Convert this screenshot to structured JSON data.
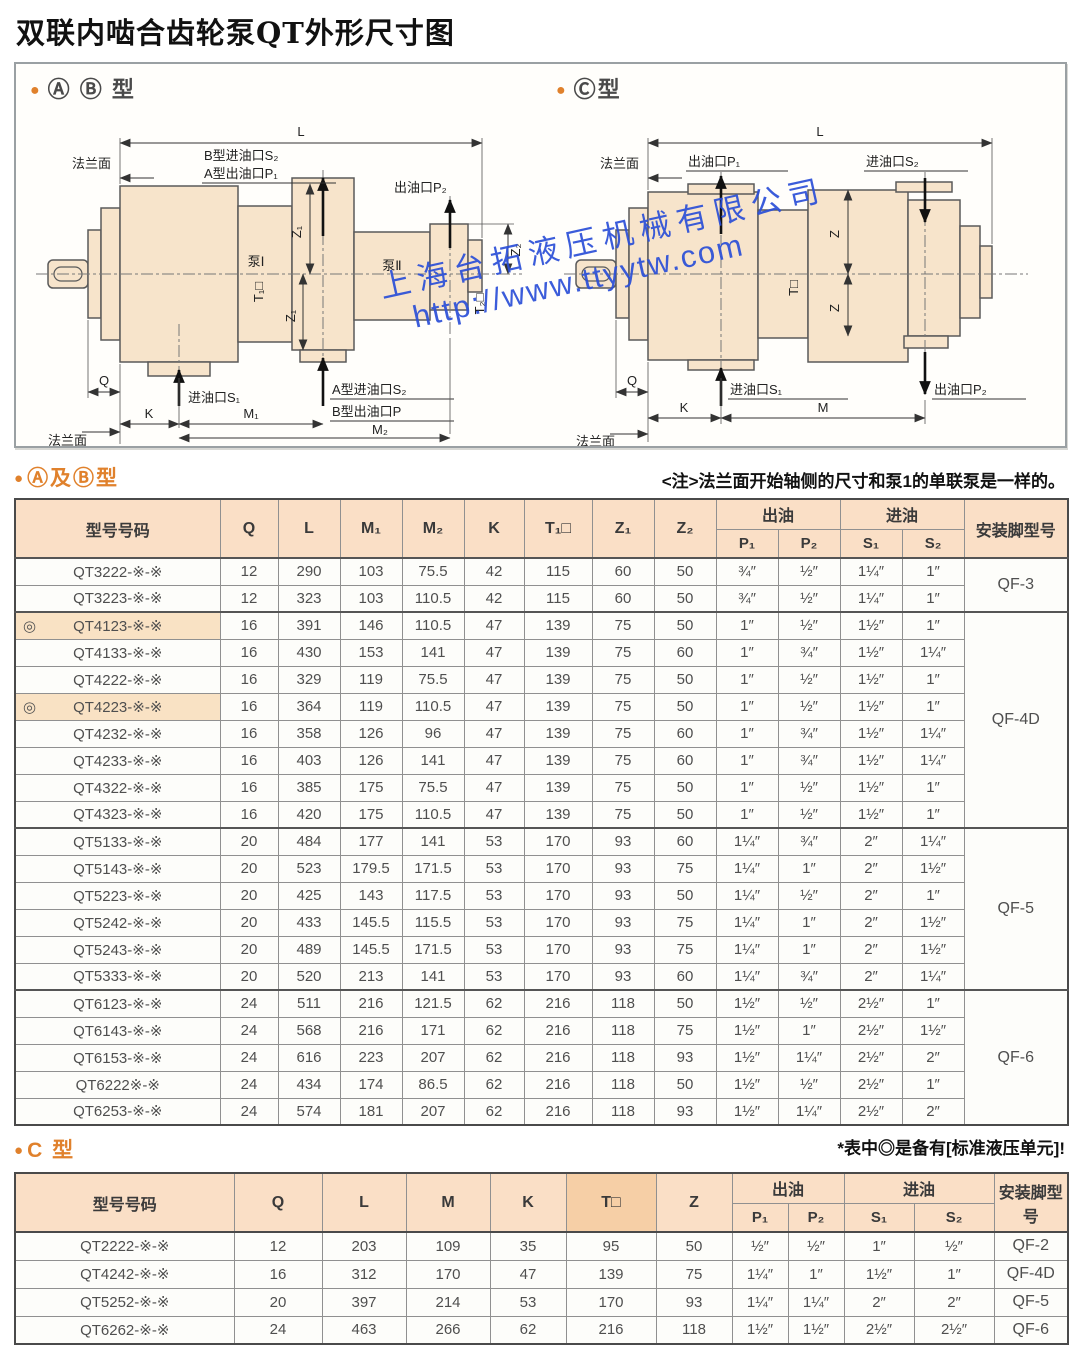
{
  "page_title": "双联内啮合齿轮泵QT外形尺寸图",
  "watermark": {
    "company": "上海台拓液压机械有限公司",
    "url": "http://www.ttyytw.com"
  },
  "diagram_ab": {
    "bullet": "●",
    "title": "Ⓐ Ⓑ 型",
    "labels": {
      "L": "L",
      "flange_top": "法兰面",
      "b_inlet_s2": "B型进油口S₂",
      "a_outlet_p1": "A型出油口P₁",
      "outlet_p2": "出油口P₂",
      "z1": "Z₁",
      "z2": "Z₂",
      "t1": "T₁□",
      "t2": "T₂□",
      "pump1": "泵Ⅰ",
      "pump2": "泵Ⅱ",
      "q": "Q",
      "k": "K",
      "m1": "M₁",
      "m2": "M₂",
      "inlet_s1": "进油口S₁",
      "a_inlet_s2": "A型进油口S₂",
      "b_outlet_p": "B型出油口P",
      "flange_bottom": "法兰面"
    }
  },
  "diagram_c": {
    "bullet": "●",
    "title": "Ⓒ型",
    "labels": {
      "L": "L",
      "flange_top": "法兰面",
      "outlet_p1": "出油口P₁",
      "inlet_s2": "进油口S₂",
      "z": "Z",
      "t": "T□",
      "q": "Q",
      "k": "K",
      "m": "M",
      "inlet_s1": "进油口S₁",
      "outlet_p2": "出油口P₂",
      "flange_bottom": "法兰面"
    }
  },
  "section_ab": {
    "bullet": "●",
    "title": "Ⓐ及Ⓑ型",
    "note": "<注>法兰面开始轴侧的尺寸和泵1的单联泵是一样的。"
  },
  "table_ab": {
    "headers": {
      "model": "型号号码",
      "q": "Q",
      "l": "L",
      "m1": "M₁",
      "m2": "M₂",
      "k": "K",
      "t1": "T₁□",
      "z1": "Z₁",
      "z2": "Z₂",
      "out": "出油",
      "in": "进油",
      "p1": "P₁",
      "p2": "P₂",
      "s1": "S₁",
      "s2": "S₂",
      "foot": "安装脚型号"
    },
    "groups": [
      {
        "start": 0,
        "span": 2,
        "label": "QF-3"
      },
      {
        "start": 2,
        "span": 8,
        "label": "QF-4D"
      },
      {
        "start": 10,
        "span": 6,
        "label": "QF-5"
      },
      {
        "start": 16,
        "span": 5,
        "label": "QF-6"
      }
    ],
    "rows": [
      {
        "mark": "",
        "model": "QT3222-※-※",
        "q": "12",
        "l": "290",
        "m1": "103",
        "m2": "75.5",
        "k": "42",
        "t1": "115",
        "z1": "60",
        "z2": "50",
        "p1": "¾″",
        "p2": "½″",
        "s1": "1¼″",
        "s2": "1″"
      },
      {
        "mark": "",
        "model": "QT3223-※-※",
        "q": "12",
        "l": "323",
        "m1": "103",
        "m2": "110.5",
        "k": "42",
        "t1": "115",
        "z1": "60",
        "z2": "50",
        "p1": "¾″",
        "p2": "½″",
        "s1": "1¼″",
        "s2": "1″"
      },
      {
        "mark": "◎",
        "model": "QT4123-※-※",
        "q": "16",
        "l": "391",
        "m1": "146",
        "m2": "110.5",
        "k": "47",
        "t1": "139",
        "z1": "75",
        "z2": "50",
        "p1": "1″",
        "p2": "½″",
        "s1": "1½″",
        "s2": "1″"
      },
      {
        "mark": "",
        "model": "QT4133-※-※",
        "q": "16",
        "l": "430",
        "m1": "153",
        "m2": "141",
        "k": "47",
        "t1": "139",
        "z1": "75",
        "z2": "60",
        "p1": "1″",
        "p2": "¾″",
        "s1": "1½″",
        "s2": "1¼″"
      },
      {
        "mark": "",
        "model": "QT4222-※-※",
        "q": "16",
        "l": "329",
        "m1": "119",
        "m2": "75.5",
        "k": "47",
        "t1": "139",
        "z1": "75",
        "z2": "50",
        "p1": "1″",
        "p2": "½″",
        "s1": "1½″",
        "s2": "1″"
      },
      {
        "mark": "◎",
        "model": "QT4223-※-※",
        "q": "16",
        "l": "364",
        "m1": "119",
        "m2": "110.5",
        "k": "47",
        "t1": "139",
        "z1": "75",
        "z2": "50",
        "p1": "1″",
        "p2": "½″",
        "s1": "1½″",
        "s2": "1″"
      },
      {
        "mark": "",
        "model": "QT4232-※-※",
        "q": "16",
        "l": "358",
        "m1": "126",
        "m2": "96",
        "k": "47",
        "t1": "139",
        "z1": "75",
        "z2": "60",
        "p1": "1″",
        "p2": "¾″",
        "s1": "1½″",
        "s2": "1¼″"
      },
      {
        "mark": "",
        "model": "QT4233-※-※",
        "q": "16",
        "l": "403",
        "m1": "126",
        "m2": "141",
        "k": "47",
        "t1": "139",
        "z1": "75",
        "z2": "60",
        "p1": "1″",
        "p2": "¾″",
        "s1": "1½″",
        "s2": "1¼″"
      },
      {
        "mark": "",
        "model": "QT4322-※-※",
        "q": "16",
        "l": "385",
        "m1": "175",
        "m2": "75.5",
        "k": "47",
        "t1": "139",
        "z1": "75",
        "z2": "50",
        "p1": "1″",
        "p2": "½″",
        "s1": "1½″",
        "s2": "1″"
      },
      {
        "mark": "",
        "model": "QT4323-※-※",
        "q": "16",
        "l": "420",
        "m1": "175",
        "m2": "110.5",
        "k": "47",
        "t1": "139",
        "z1": "75",
        "z2": "50",
        "p1": "1″",
        "p2": "½″",
        "s1": "1½″",
        "s2": "1″"
      },
      {
        "mark": "",
        "model": "QT5133-※-※",
        "q": "20",
        "l": "484",
        "m1": "177",
        "m2": "141",
        "k": "53",
        "t1": "170",
        "z1": "93",
        "z2": "60",
        "p1": "1¼″",
        "p2": "¾″",
        "s1": "2″",
        "s2": "1¼″"
      },
      {
        "mark": "",
        "model": "QT5143-※-※",
        "q": "20",
        "l": "523",
        "m1": "179.5",
        "m2": "171.5",
        "k": "53",
        "t1": "170",
        "z1": "93",
        "z2": "75",
        "p1": "1¼″",
        "p2": "1″",
        "s1": "2″",
        "s2": "1½″"
      },
      {
        "mark": "",
        "model": "QT5223-※-※",
        "q": "20",
        "l": "425",
        "m1": "143",
        "m2": "117.5",
        "k": "53",
        "t1": "170",
        "z1": "93",
        "z2": "50",
        "p1": "1¼″",
        "p2": "½″",
        "s1": "2″",
        "s2": "1″"
      },
      {
        "mark": "",
        "model": "QT5242-※-※",
        "q": "20",
        "l": "433",
        "m1": "145.5",
        "m2": "115.5",
        "k": "53",
        "t1": "170",
        "z1": "93",
        "z2": "75",
        "p1": "1¼″",
        "p2": "1″",
        "s1": "2″",
        "s2": "1½″"
      },
      {
        "mark": "",
        "model": "QT5243-※-※",
        "q": "20",
        "l": "489",
        "m1": "145.5",
        "m2": "171.5",
        "k": "53",
        "t1": "170",
        "z1": "93",
        "z2": "75",
        "p1": "1¼″",
        "p2": "1″",
        "s1": "2″",
        "s2": "1½″"
      },
      {
        "mark": "",
        "model": "QT5333-※-※",
        "q": "20",
        "l": "520",
        "m1": "213",
        "m2": "141",
        "k": "53",
        "t1": "170",
        "z1": "93",
        "z2": "60",
        "p1": "1¼″",
        "p2": "¾″",
        "s1": "2″",
        "s2": "1¼″"
      },
      {
        "mark": "",
        "model": "QT6123-※-※",
        "q": "24",
        "l": "511",
        "m1": "216",
        "m2": "121.5",
        "k": "62",
        "t1": "216",
        "z1": "118",
        "z2": "50",
        "p1": "1½″",
        "p2": "½″",
        "s1": "2½″",
        "s2": "1″"
      },
      {
        "mark": "",
        "model": "QT6143-※-※",
        "q": "24",
        "l": "568",
        "m1": "216",
        "m2": "171",
        "k": "62",
        "t1": "216",
        "z1": "118",
        "z2": "75",
        "p1": "1½″",
        "p2": "1″",
        "s1": "2½″",
        "s2": "1½″"
      },
      {
        "mark": "",
        "model": "QT6153-※-※",
        "q": "24",
        "l": "616",
        "m1": "223",
        "m2": "207",
        "k": "62",
        "t1": "216",
        "z1": "118",
        "z2": "93",
        "p1": "1½″",
        "p2": "1¼″",
        "s1": "2½″",
        "s2": "2″"
      },
      {
        "mark": "",
        "model": "QT6222※-※",
        "q": "24",
        "l": "434",
        "m1": "174",
        "m2": "86.5",
        "k": "62",
        "t1": "216",
        "z1": "118",
        "z2": "50",
        "p1": "1½″",
        "p2": "½″",
        "s1": "2½″",
        "s2": "1″"
      },
      {
        "mark": "",
        "model": "QT6253-※-※",
        "q": "24",
        "l": "574",
        "m1": "181",
        "m2": "207",
        "k": "62",
        "t1": "216",
        "z1": "118",
        "z2": "93",
        "p1": "1½″",
        "p2": "1¼″",
        "s1": "2½″",
        "s2": "2″"
      }
    ],
    "footnote": "*表中◎是备有[标准液压单元]!"
  },
  "section_c": {
    "bullet": "●",
    "title": "C 型"
  },
  "table_c": {
    "headers": {
      "model": "型号号码",
      "q": "Q",
      "l": "L",
      "m": "M",
      "k": "K",
      "t": "T□",
      "z": "Z",
      "out": "出油",
      "in": "进油",
      "p1": "P₁",
      "p2": "P₂",
      "s1": "S₁",
      "s2": "S₂",
      "foot": "安装脚型号"
    },
    "rows": [
      {
        "mark": "",
        "model": "QT2222-※-※",
        "q": "12",
        "l": "203",
        "m": "109",
        "k": "35",
        "t": "95",
        "z": "50",
        "p1": "½″",
        "p2": "½″",
        "s1": "1″",
        "s2": "½″",
        "foot": "QF-2"
      },
      {
        "mark": "",
        "model": "QT4242-※-※",
        "q": "16",
        "l": "312",
        "m": "170",
        "k": "47",
        "t": "139",
        "z": "75",
        "p1": "1¼″",
        "p2": "1″",
        "s1": "1½″",
        "s2": "1″",
        "foot": "QF-4D"
      },
      {
        "mark": "",
        "model": "QT5252-※-※",
        "q": "20",
        "l": "397",
        "m": "214",
        "k": "53",
        "t": "170",
        "z": "93",
        "p1": "1¼″",
        "p2": "1¼″",
        "s1": "2″",
        "s2": "2″",
        "foot": "QF-5"
      },
      {
        "mark": "",
        "model": "QT6262-※-※",
        "q": "24",
        "l": "463",
        "m": "266",
        "k": "62",
        "t": "216",
        "z": "118",
        "p1": "1½″",
        "p2": "1½″",
        "s1": "2½″",
        "s2": "2½″",
        "foot": "QF-6"
      }
    ]
  }
}
